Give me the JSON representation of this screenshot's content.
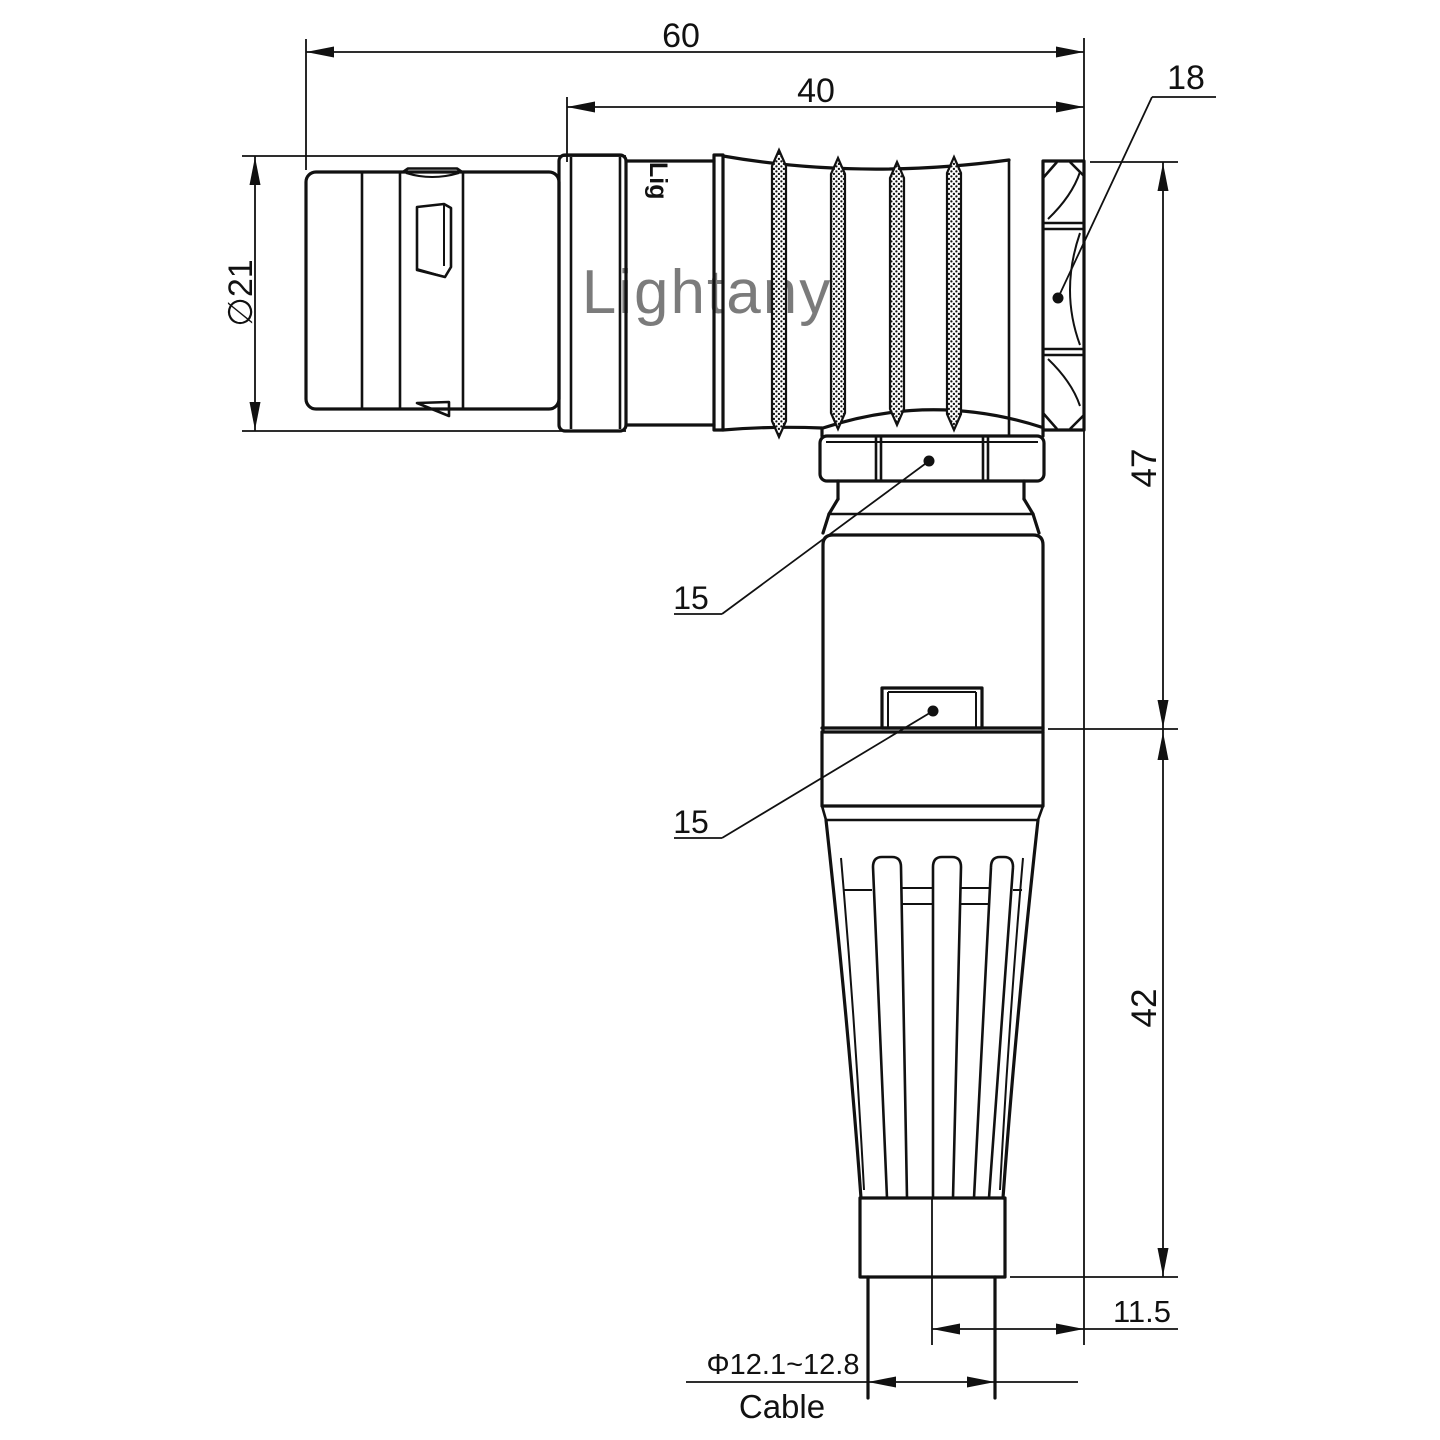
{
  "page": {
    "background": "#ffffff"
  },
  "drawing": {
    "watermark": "Lightany",
    "part_marking": "Lig",
    "line_color": "#111111",
    "watermark_color": "#e8a3a3",
    "dimensions": {
      "overall_length": "60",
      "rear_length": "40",
      "coupling_nut_size": "18",
      "front_diameter": "∅21",
      "elbow_height": "47",
      "boot_height": "42",
      "cable_axis_offset": "11.5",
      "cable_diameter_range": "Φ12.1~12.8",
      "cable_label": "Cable",
      "clamp_nut_callout": "15",
      "backshell_callout": "15"
    }
  }
}
